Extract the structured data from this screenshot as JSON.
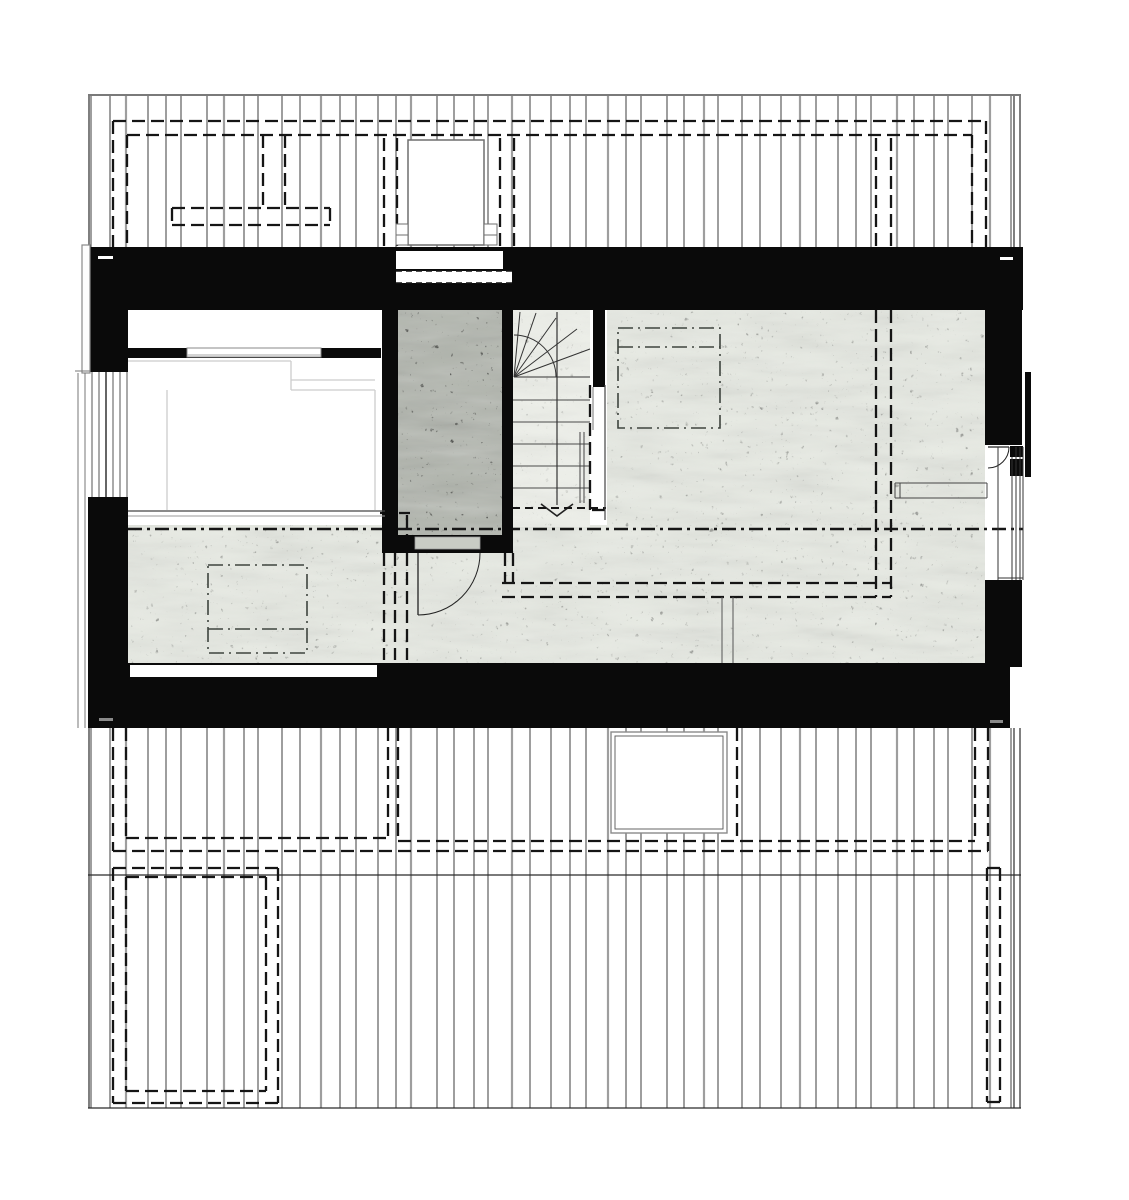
{
  "drawing": {
    "kind": "architectural-floor-plan",
    "canvas": {
      "w": 1129,
      "h": 1200,
      "bg": "#ffffff"
    },
    "colors": {
      "wall": "#0a0a0a",
      "board": "#3d3d3d",
      "boardThick": "#9e9e9e",
      "edge": "#2b2b2b",
      "dash": "#151515",
      "dashdot": "#3e443e",
      "faint": "#cccccc",
      "frame": "#6f6f6f",
      "concreteLight": "#e7eae3",
      "concretePale": "#eef0ea",
      "concreteDark": "#b2b6ae",
      "threshold": "#c9ccc5",
      "grayTick": "#8a8a8a",
      "white": "#ffffff"
    },
    "styles": {
      "dash": {
        "w": 2.3,
        "da": "13 6"
      },
      "dashSmall": {
        "w": 1.9,
        "da": "8 5"
      },
      "dashdot": {
        "w": 1.6,
        "da": "15 5 2 5"
      },
      "section": {
        "w": 2.5,
        "da": "14 5 3 5"
      },
      "stripDash": {
        "w": 1.6,
        "da": "6 4"
      }
    },
    "boards": {
      "pattern": [
        19,
        16,
        22,
        18,
        15,
        26,
        17,
        20,
        14,
        24,
        18,
        21
      ],
      "thick_every": 5,
      "top": {
        "x1": 91,
        "x2": 1012,
        "y1": 96,
        "y2": 255
      },
      "bottom": {
        "x1": 91,
        "x2": 1012,
        "y1": 728,
        "y2": 1108
      }
    },
    "band_edges": {
      "top": [
        [
          88,
          95,
          1021,
          95
        ],
        [
          89,
          96,
          89,
          250
        ],
        [
          1014,
          96,
          1014,
          255
        ],
        [
          1020,
          96,
          1020,
          255
        ]
      ],
      "bottom": [
        [
          88,
          875,
          1021,
          875
        ],
        [
          88,
          1108,
          1021,
          1108
        ],
        [
          89,
          728,
          89,
          1108
        ],
        [
          1014,
          728,
          1014,
          1108
        ],
        [
          1020,
          728,
          1020,
          1108
        ]
      ]
    },
    "roof_dashed_top": {
      "outer_h": [
        113,
        121,
        986,
        121
      ],
      "inner_h": [
        127,
        135,
        972,
        135
      ],
      "verts": [
        [
          113,
          121,
          113,
          250
        ],
        [
          127,
          135,
          127,
          250
        ],
        [
          986,
          121,
          986,
          250
        ],
        [
          972,
          135,
          972,
          250
        ],
        [
          263,
          135,
          263,
          208
        ],
        [
          285,
          135,
          285,
          208
        ],
        [
          876,
          138,
          876,
          250
        ],
        [
          891,
          138,
          891,
          250
        ]
      ],
      "bar": [
        172,
        208,
        158,
        17
      ]
    },
    "chimney": {
      "box": [
        408,
        140,
        76,
        105
      ],
      "tabs": [
        [
          396,
          224,
          12,
          21
        ],
        [
          484,
          224,
          13,
          21
        ]
      ],
      "tab_mid_y": 235,
      "pairs": [
        [
          384,
          138,
          384,
          247
        ],
        [
          397,
          138,
          397,
          247
        ],
        [
          500,
          138,
          500,
          247
        ],
        [
          514,
          138,
          514,
          247
        ]
      ],
      "window": [
        396,
        251,
        107,
        18
      ],
      "dash_strip": [
        396,
        271,
        116,
        12
      ]
    },
    "roof_dashed_bottom": {
      "lines": [
        [
          113,
          728,
          113,
          851
        ],
        [
          988,
          728,
          988,
          851
        ],
        [
          113,
          851,
          988,
          851
        ],
        [
          126,
          728,
          126,
          838
        ],
        [
          388,
          728,
          388,
          838
        ],
        [
          126,
          838,
          388,
          838
        ],
        [
          398,
          728,
          398,
          841
        ],
        [
          975,
          728,
          975,
          841
        ],
        [
          398,
          841,
          975,
          841
        ],
        [
          737,
          728,
          737,
          838
        ]
      ],
      "rects": [
        [
          113,
          868,
          165,
          235
        ],
        [
          126,
          877,
          140,
          214
        ],
        [
          987,
          868,
          13,
          234
        ]
      ]
    },
    "skylight_box": {
      "outer": [
        611,
        732,
        116,
        101
      ],
      "inner": [
        615,
        736,
        108,
        93
      ]
    },
    "floors": {
      "bedroom": [
        128,
        310,
        254,
        200
      ],
      "big_room": [
        607,
        310,
        378,
        353
      ],
      "hall": [
        128,
        525,
        857,
        138
      ],
      "stair_zone": [
        512,
        310,
        78,
        203
      ],
      "patch_b": [
        512,
        513,
        78,
        14
      ],
      "shaft": [
        398,
        310,
        104,
        225
      ]
    },
    "walls": [
      [
        88,
        247,
        935,
        63
      ],
      [
        88,
        247,
        40,
        125
      ],
      [
        88,
        497,
        40,
        231
      ],
      [
        88,
        663,
        922,
        65
      ],
      [
        985,
        310,
        37,
        135
      ],
      [
        985,
        580,
        37,
        87
      ],
      [
        128,
        348,
        253,
        10
      ],
      [
        382,
        310,
        16,
        243
      ],
      [
        502,
        310,
        11,
        243
      ],
      [
        382,
        535,
        131,
        18
      ],
      [
        593,
        310,
        12,
        77
      ]
    ],
    "openings": {
      "bottom_slot": [
        130,
        665,
        247,
        12
      ],
      "shaft_threshold": [
        415,
        537,
        65,
        12
      ],
      "joints": [
        {
          "r": [
            98,
            256,
            15,
            3
          ],
          "c": "#ffffff"
        },
        {
          "r": [
            1000,
            257,
            13,
            3
          ],
          "c": "#ffffff"
        },
        {
          "r": [
            99,
            718,
            14,
            3
          ],
          "c": "#8a8a8a"
        },
        {
          "r": [
            990,
            720,
            13,
            3
          ],
          "c": "#8a8a8a"
        }
      ],
      "niche_window": {
        "rect": [
          187,
          348,
          134,
          9
        ],
        "mid": [
          187,
          355,
          321,
          355
        ]
      }
    },
    "bed_lines": [
      [
        128,
        361,
        291,
        361
      ],
      [
        291,
        361,
        291,
        390
      ],
      [
        291,
        390,
        375,
        390
      ],
      [
        291,
        380,
        375,
        380
      ],
      [
        375,
        390,
        375,
        510
      ],
      [
        167,
        390,
        167,
        510
      ]
    ],
    "room_lines": [
      {
        "p": [
          722,
          597,
          722,
          663
        ],
        "c": "#555555",
        "w": 1
      },
      {
        "p": [
          733,
          597,
          733,
          663
        ],
        "c": "#555555",
        "w": 1
      },
      {
        "p": [
          128,
          511,
          385,
          511
        ],
        "c": "#444444",
        "w": 1.2
      },
      {
        "p": [
          128,
          516,
          385,
          516
        ],
        "c": "#9a9a9a",
        "w": 1
      },
      {
        "p": [
          605,
          385,
          605,
          520
        ],
        "c": "#444444",
        "w": 1.2
      },
      {
        "p": [
          593,
          387,
          593,
          430
        ],
        "c": "#777777",
        "w": 1
      }
    ],
    "counter_lines": [
      [
        895,
        483,
        987,
        483
      ],
      [
        895,
        498,
        987,
        498
      ],
      [
        895,
        483,
        895,
        498
      ],
      [
        987,
        483,
        987,
        498
      ],
      [
        900,
        483,
        900,
        498
      ]
    ],
    "interior_dashed": [
      [
        876,
        310,
        876,
        597
      ],
      [
        891,
        310,
        891,
        597
      ],
      [
        502,
        583,
        891,
        583
      ],
      [
        502,
        597,
        891,
        597
      ],
      [
        505,
        553,
        505,
        583
      ],
      [
        513,
        553,
        513,
        583
      ],
      [
        590,
        385,
        590,
        510
      ],
      [
        592,
        510,
        606,
        510
      ],
      [
        384,
        515,
        384,
        660
      ],
      [
        395,
        515,
        395,
        660
      ],
      [
        407,
        515,
        407,
        660
      ],
      [
        380,
        513,
        410,
        513
      ]
    ],
    "section_line": [
      128,
      529,
      1023,
      529
    ],
    "dashdot_squares": [
      {
        "r": [
          208,
          565,
          99,
          88
        ],
        "inner_y": 629
      },
      {
        "r": [
          618,
          328,
          102,
          100
        ],
        "inner_y": 347
      }
    ],
    "stairs": {
      "pivot": [
        514,
        377
      ],
      "fan": [
        [
          520,
          312
        ],
        [
          536,
          313
        ],
        [
          556,
          318
        ],
        [
          577,
          329
        ],
        [
          590,
          349
        ],
        [
          590,
          377
        ]
      ],
      "arc_path": "M 514 335 A 42 42 0 0 1 556 377",
      "treads_y": [
        400,
        422,
        444,
        466,
        488
      ],
      "tread_x": [
        512,
        590
      ],
      "walkline": [
        557,
        312,
        557,
        505
      ],
      "arrow": [
        [
          541,
          504
        ],
        [
          557,
          516
        ],
        [
          573,
          504
        ]
      ],
      "break_line": [
        512,
        508,
        606,
        508
      ],
      "handrail": [
        [
          580,
          432,
          580,
          503
        ],
        [
          584,
          432,
          584,
          503
        ]
      ]
    },
    "doors": {
      "hall": {
        "leaf": [
          418,
          553,
          418,
          615
        ],
        "arc": "M 480 553 A 62 62 0 0 1 418 615"
      },
      "balcony": {
        "leaf": [
          988,
          447,
          1009,
          447
        ],
        "arc": "M 1009 447 A 21 21 0 0 1 988 468",
        "jambs": [
          [
            1010,
            446,
            13,
            11
          ],
          [
            1010,
            459,
            13,
            17
          ]
        ]
      }
    },
    "balcony_railing": [
      1025,
      372,
      6,
      105
    ],
    "window_right": {
      "verts": [
        [
          998,
          447,
          998,
          580
        ],
        [
          1012,
          457,
          1012,
          580
        ],
        [
          1016,
          447,
          1016,
          580
        ],
        [
          1020,
          447,
          1020,
          580
        ],
        [
          1023,
          447,
          1023,
          580
        ]
      ],
      "sill": [
        998,
        578,
        1023,
        578
      ]
    },
    "gable_left": {
      "bargeboard": [
        82,
        245,
        8,
        128
      ],
      "eave_lines": [
        [
          78,
          373,
          78,
          728
        ],
        [
          85,
          373,
          85,
          728
        ],
        [
          75,
          371,
          90,
          371
        ]
      ],
      "window_lines": [
        [
          92,
          372,
          92,
          497
        ],
        [
          99,
          372,
          99,
          497
        ],
        [
          106,
          372,
          106,
          497
        ],
        [
          113,
          372,
          113,
          497
        ],
        [
          120,
          372,
          120,
          497
        ],
        [
          127,
          372,
          127,
          497
        ]
      ]
    }
  }
}
